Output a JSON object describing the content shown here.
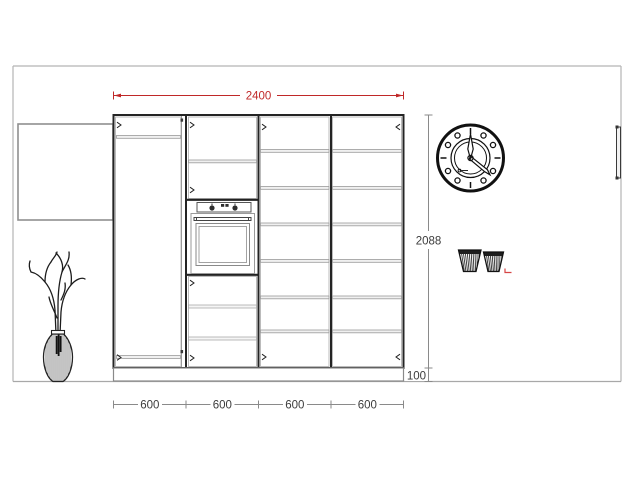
{
  "labels": {
    "total_width": "2400",
    "cabinet_height": "2088",
    "plinth_height": "100",
    "sections": [
      "600",
      "600",
      "600",
      "600"
    ]
  },
  "colors": {
    "dimension_accent_red": "#c02828",
    "dimension_text": "#3c3c3c",
    "dimension_line": "#8a8a8a",
    "cabinet_dark_line": "#242424",
    "cabinet_gray_line": "#9a9a9a",
    "wall_line": "#b5b5b5",
    "selection_mark_red": "#d64545"
  },
  "objects": {
    "scene": "kitchen-elevation-drawing",
    "cabinet": "tall-cabinet-run-4-sections",
    "appliance": "built-in-oven",
    "decor": [
      "wall-clock",
      "vase-with-branches",
      "two-baskets"
    ],
    "door": "door-handle-right-wall",
    "side": "left-side-panel"
  }
}
